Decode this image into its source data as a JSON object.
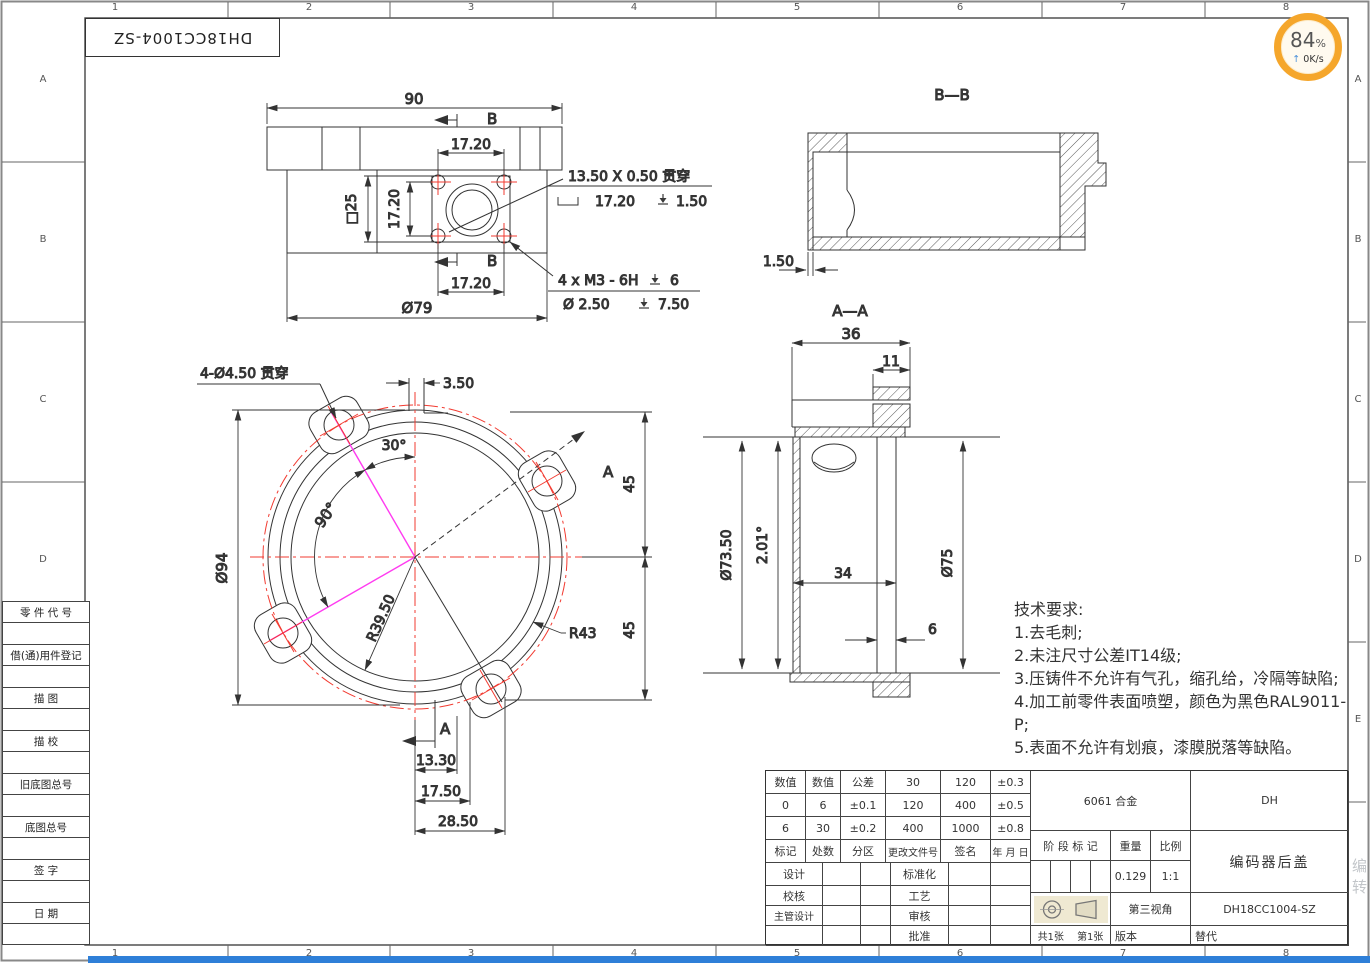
{
  "frame": {
    "part_no": "DH18CC1004-SZ"
  },
  "zones": {
    "cols": [
      "1",
      "2",
      "3",
      "4",
      "5",
      "6",
      "7",
      "8"
    ],
    "rows_left": [
      "A",
      "B",
      "C",
      "D"
    ],
    "rows_right": [
      "A",
      "B",
      "C",
      "D",
      "E"
    ]
  },
  "status_badge": {
    "percent": "84",
    "unit": "%",
    "arrow": "↑",
    "speed": "0K/s"
  },
  "watermark": "编转",
  "views": {
    "rear": {
      "section_label": "B",
      "dim_overall": "90",
      "dim_pitch": "17.20",
      "dim_square": "□25",
      "dim_flange": "Ø79",
      "cbore_line1": "13.50 X 0.50 贯穿",
      "cbore_width": "17.20",
      "cbore_depth": "1.50",
      "thread_spec": "4 x  M3 - 6H",
      "thread_depth": "6",
      "pilot_spec": "Ø 2.50",
      "pilot_depth": "7.50"
    },
    "section_bb": {
      "title": "B—B",
      "dim_wall": "1.50"
    },
    "section_aa": {
      "title": "A—A",
      "dim_width": "36",
      "dim_boss": "11",
      "dim_inner": "Ø73.50",
      "dim_draft": "2.01°",
      "dim_depth": "34",
      "dim_outer": "Ø75",
      "dim_step": "6"
    },
    "front": {
      "callout": "4-Ø4.50 贯穿",
      "dim_slot": "3.50",
      "dim_a30": "30°",
      "dim_a90": "90°",
      "dim_dia": "Ø94",
      "dim_r1": "R39.50",
      "dim_r2": "R43",
      "dim_45a": "45",
      "dim_45b": "45",
      "dim_b1": "13.30",
      "dim_b2": "17.50",
      "dim_b3": "28.50",
      "section_label": "A"
    }
  },
  "tech": {
    "title": "技术要求:",
    "items": [
      "1.去毛刺;",
      "2.未注尺寸公差IT14级;",
      "3.压铸件不允许有气孔，缩孔给，冷隔等缺陷;",
      "4.加工前零件表面喷塑，颜色为黑色RAL9011-P;",
      "5.表面不允许有划痕，漆膜脱落等缺陷。"
    ]
  },
  "titleblock": {
    "tol_rows": [
      [
        "数值",
        "数值",
        "公差",
        "30",
        "120",
        "±0.3"
      ],
      [
        "0",
        "6",
        "±0.1",
        "120",
        "400",
        "±0.5"
      ],
      [
        "6",
        "30",
        "±0.2",
        "400",
        "1000",
        "±0.8"
      ],
      [
        "标记",
        "处数",
        "分区",
        "更改文件号",
        "签名",
        "年 月 日"
      ]
    ],
    "sig_rows": [
      [
        "设计",
        "标准化"
      ],
      [
        "校核",
        "工艺"
      ],
      [
        "主管设计",
        "审核"
      ],
      [
        "",
        "批准"
      ]
    ],
    "material": "6061 合金",
    "company": "DH",
    "stage_label": "阶 段 标 记",
    "weight_label": "重量",
    "scale_label": "比例",
    "weight": "0.129",
    "scale": "1:1",
    "projection": "第三视角",
    "part_name": "编码器后盖",
    "drawing_no": "DH18CC1004-SZ",
    "sheet_total": "共1张",
    "sheet_no": "第1张",
    "version_label": "版本",
    "substitute_label": "替代"
  },
  "side_table": [
    "零 件 代 号",
    "借(通)用件登记",
    "描 图",
    "描 校",
    "旧底图总号",
    "底图总号",
    "签 字",
    "日 期"
  ],
  "colors": {
    "accent_orange": "#f5a62b",
    "centerline_red": "#f23b31",
    "construction_magenta": "#ff3bf0",
    "taskbar_blue": "#2e7fd8"
  }
}
